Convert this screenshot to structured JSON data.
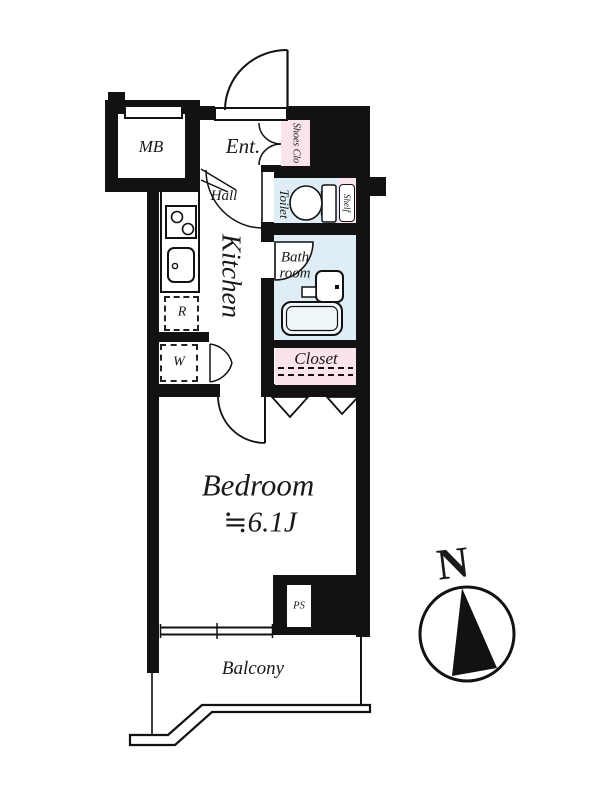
{
  "floorplan": {
    "rooms": {
      "mb": "MB",
      "entrance": "Ent.",
      "shoes_closet": "Shoes Clo",
      "hall": "Hall",
      "toilet": "Toilet",
      "shelf": "Shelf",
      "kitchen": "Kitchen",
      "bathroom_line1": "Bath",
      "bathroom_line2": "room",
      "refrigerator": "R",
      "washer": "W",
      "closet": "Closet",
      "bedroom": "Bedroom",
      "bedroom_size_approx": "≒",
      "bedroom_size_value": "6.1J",
      "pipe_space": "PS",
      "balcony": "Balcony"
    },
    "compass_north": "N",
    "colors": {
      "wall": "#121212",
      "wet_room_fill": "#dfeef6",
      "storage_fill": "#fbe3ec",
      "line": "#1a1a1a",
      "background": "#ffffff"
    }
  }
}
